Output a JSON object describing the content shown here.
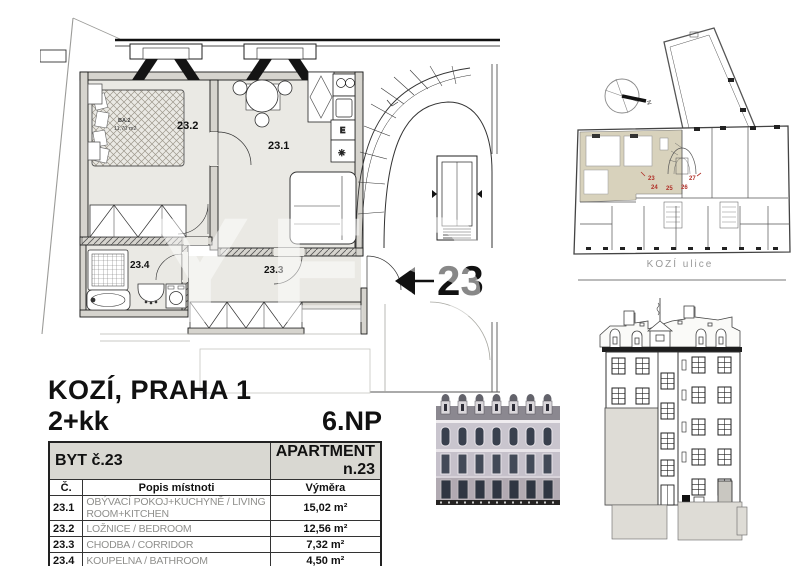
{
  "titleblock": {
    "location": "KOZÍ, PRAHA 1",
    "layout": "2+kk",
    "floor": "6.NP"
  },
  "table": {
    "header_left": "BYT č.23",
    "header_right": "APARTMENT n.23",
    "columns": [
      "Č.",
      "Popis místnoti",
      "Výměra"
    ],
    "rows": [
      {
        "num": "23.1",
        "desc": "OBÝVACÍ POKOJ+KUCHYNĚ / LIVING ROOM+KITCHEN",
        "area": "15,02 m²"
      },
      {
        "num": "23.2",
        "desc": "LOŽNICE / BEDROOM",
        "area": "12,56 m²"
      },
      {
        "num": "23.3",
        "desc": "CHODBA / CORRIDOR",
        "area": "7,32 m²"
      },
      {
        "num": "23.4",
        "desc": "KOUPELNA / BATHROOM",
        "area": "4,50 m²"
      }
    ],
    "total_label": "TOTAL",
    "total_area": "39,40 m²"
  },
  "floorplan": {
    "rooms": {
      "living": "23.1",
      "bedroom": "23.2",
      "corridor": "23.3",
      "bathroom": "23.4"
    },
    "unit_callout": "23",
    "bed_label_1": "BA.2",
    "bed_label_2": "11,70 m2",
    "kitchen_electric": "E",
    "kitchen_fridge": "✳"
  },
  "siteplan": {
    "street": "KOZÍ ulice",
    "north": "N",
    "units": [
      "23",
      "24",
      "25",
      "26",
      "27"
    ]
  },
  "watermark": "YES",
  "colors": {
    "room_fill": "#eae9e4",
    "wall_fill": "#d6d4ce",
    "highlight_fill": "#d8d2bc",
    "red_label": "#b03028",
    "table_header_bg": "#d9d8d2"
  }
}
